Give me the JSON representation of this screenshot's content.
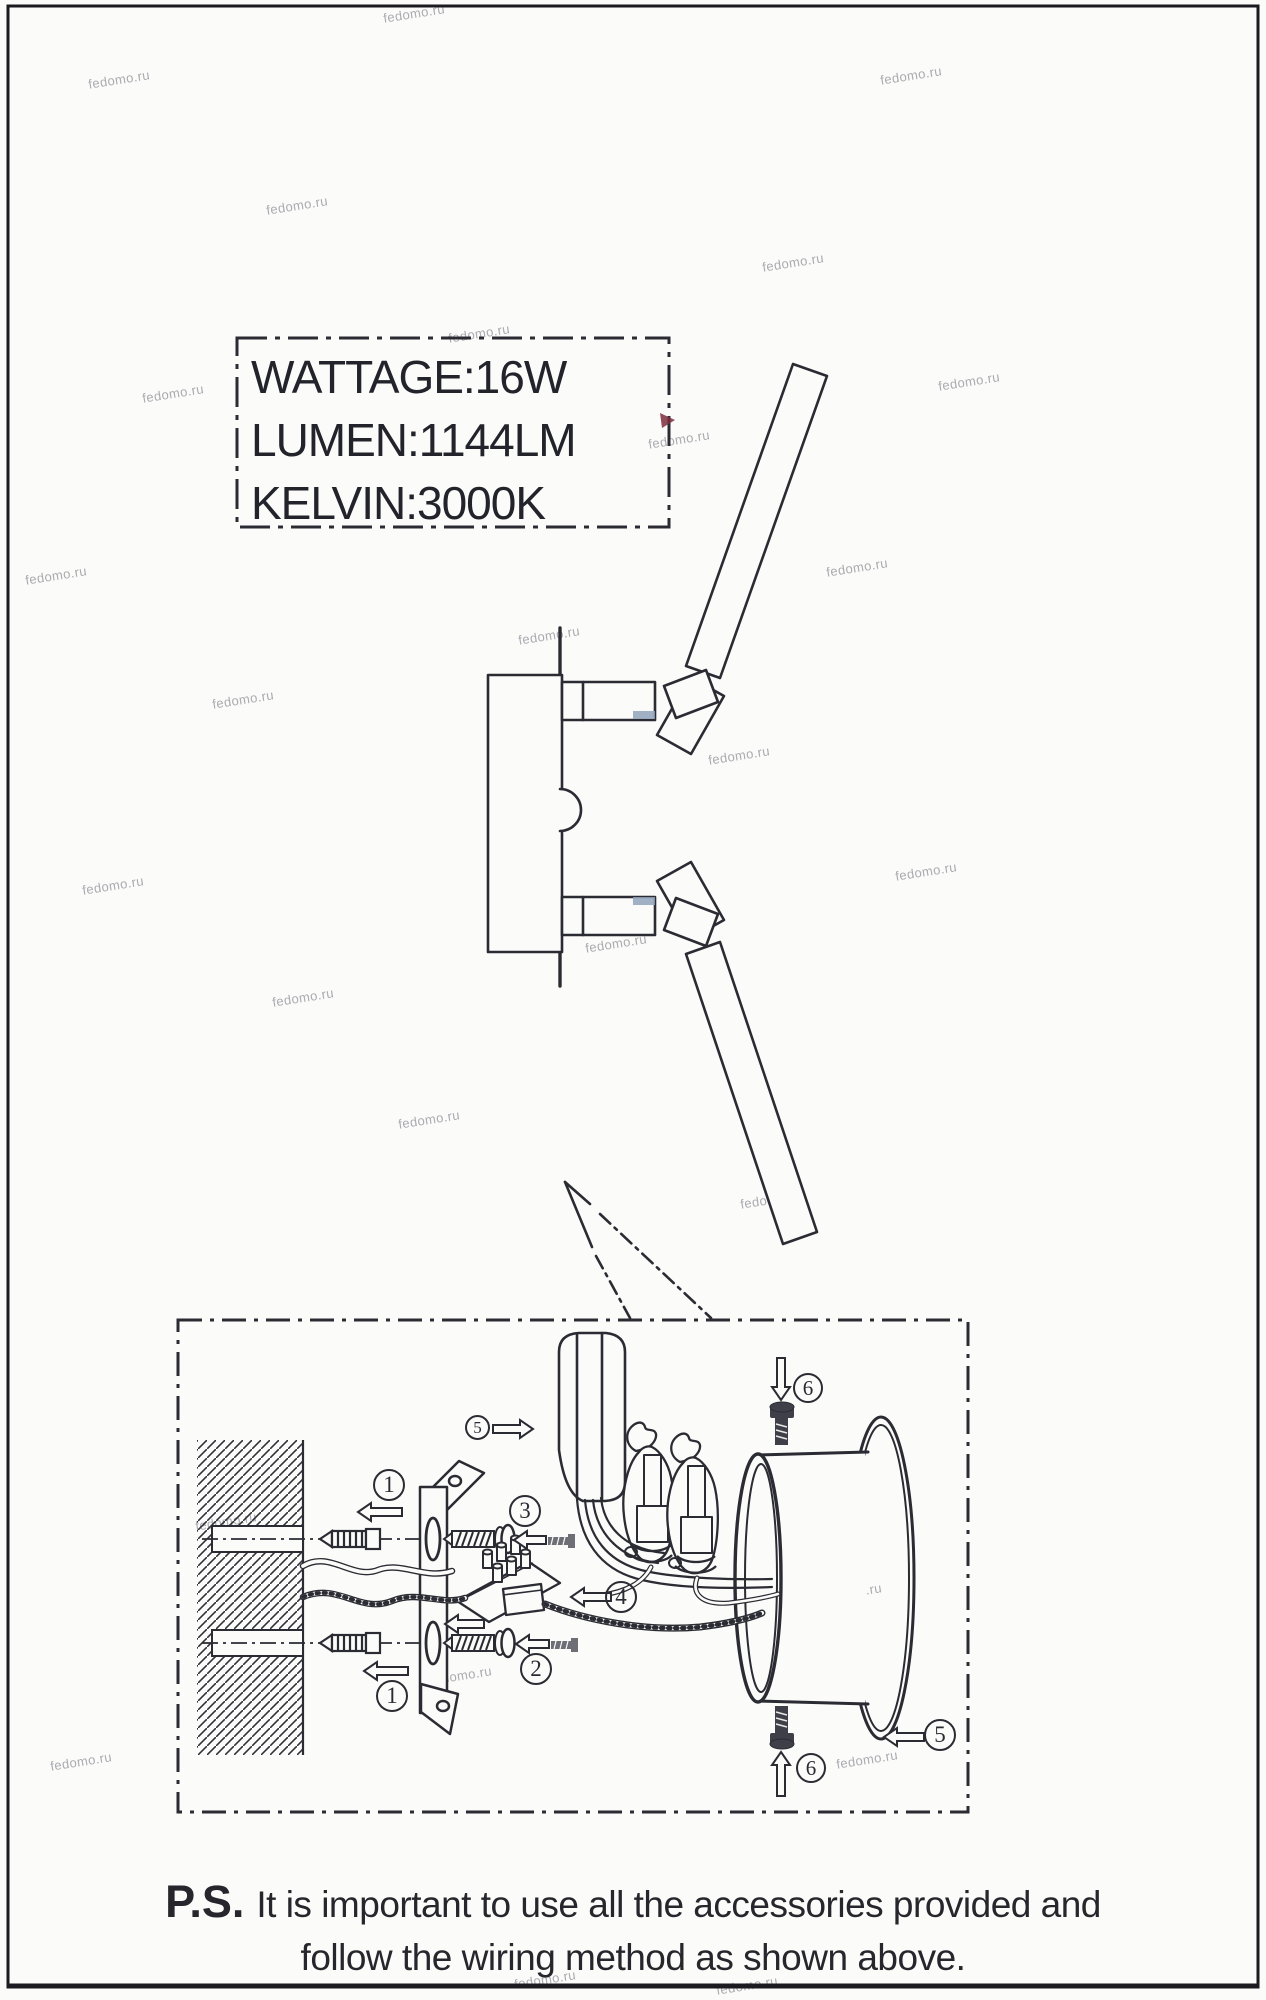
{
  "page": {
    "watermark_text": "fedomo.ru"
  },
  "spec_box": {
    "wattage": "WATTAGE:16W",
    "lumen": "LUMEN:1144LM",
    "kelvin": "KELVIN:3000K"
  },
  "callouts": {
    "step1": "1",
    "step2": "2",
    "step3": "3",
    "step4": "4",
    "step5": "5",
    "step6": "6"
  },
  "footnote": {
    "prefix": "P.S.",
    "line1": "It is important to use all the accessories provided and",
    "line2": "follow the wiring method as shown above."
  },
  "colors": {
    "ink": "#2b2b33",
    "accent_mark": "#7d2d3c",
    "metal_accent": "#8fa3bd"
  }
}
